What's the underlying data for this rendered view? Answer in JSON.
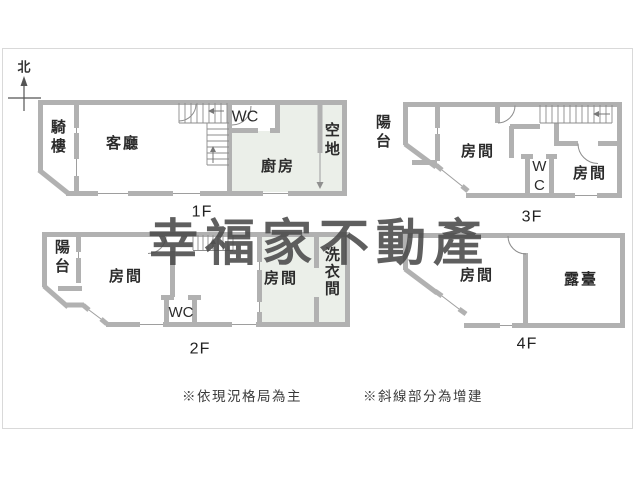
{
  "north": {
    "label": "北"
  },
  "watermark": {
    "text": "幸福家不動產",
    "color": "#4a4a4a"
  },
  "floors": [
    {
      "label": "1F",
      "rooms": {
        "arcade": "騎樓",
        "living": "客廳",
        "wc": "WC",
        "kitchen": "廚房",
        "open_space": "空地"
      }
    },
    {
      "label": "2F",
      "rooms": {
        "balcony": "陽台",
        "room_left": "房間",
        "wc": "WC",
        "room_right": "房間",
        "laundry": "洗衣間"
      }
    },
    {
      "label": "3F",
      "rooms": {
        "balcony": "陽台",
        "room_left": "房間",
        "wc": "WC",
        "room_right": "房間"
      }
    },
    {
      "label": "4F",
      "rooms": {
        "room": "房間",
        "terrace": "露臺"
      }
    }
  ],
  "notes": [
    {
      "text": "※依現況格局為主"
    },
    {
      "text": "※斜線部分為增建"
    }
  ],
  "colors": {
    "wall": "#b1b1b1",
    "shade": "#ebefe9",
    "thin_line": "#9e9e9e",
    "text": "#2b2b2b",
    "frame": "#d9d9d9"
  }
}
